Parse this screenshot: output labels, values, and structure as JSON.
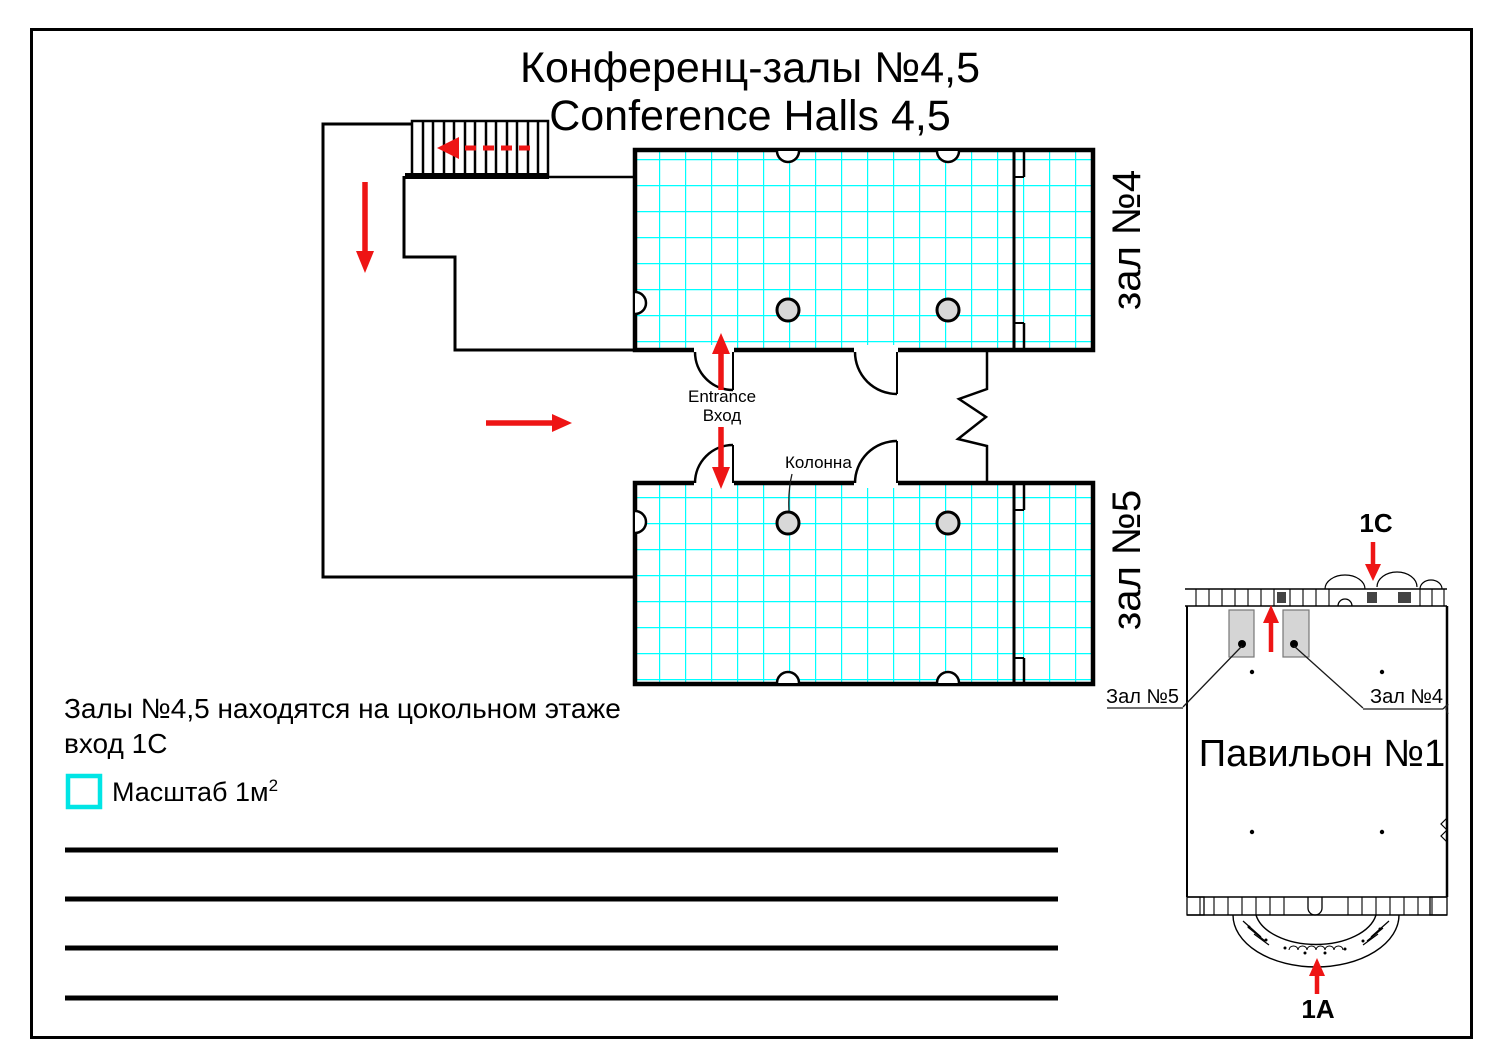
{
  "title": {
    "line1_ru": "Конференц-залы №4,5",
    "line2_en": "Conference Halls 4,5"
  },
  "plan": {
    "hall4_side_label": "зал №4",
    "hall5_side_label": "зал №5",
    "entrance_label_en": "Entrance",
    "entrance_label_ru": "Вход",
    "column_label": "Колонна"
  },
  "notes": {
    "location_line1": "Залы №4,5 находятся на цокольном этаже",
    "location_line2": "вход 1С",
    "scale_label": "Масштаб 1м",
    "scale_superscript": "2"
  },
  "minimap": {
    "entrance_top_label": "1С",
    "entrance_bottom_label": "1А",
    "hall5_label": "Зал №5",
    "hall4_label": "Зал №4",
    "pavilion_label": "Павильон №1"
  },
  "colors": {
    "grid_cyan": "#00FFFF",
    "legend_cyan": "#00E5E5",
    "arrow_red": "#EE1515",
    "wall_black": "#000000",
    "column_fill": "#D8D8D8",
    "minimap_hall_fill": "#D5D5D5"
  }
}
